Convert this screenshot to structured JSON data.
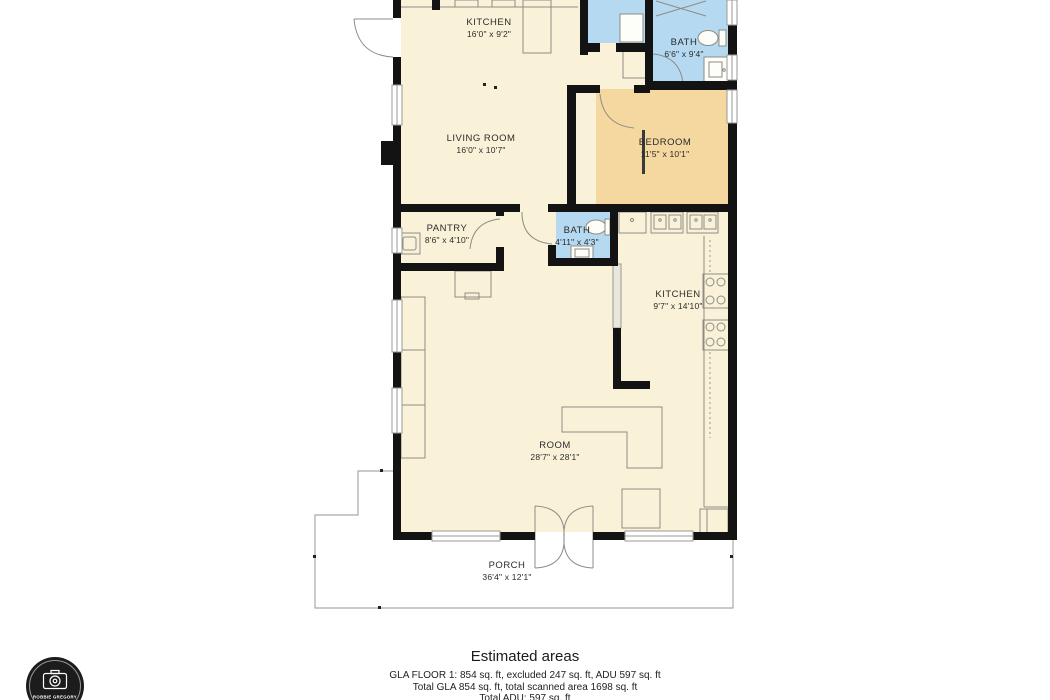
{
  "plan": {
    "rooms": [
      {
        "id": "kitchen-1",
        "name": "KITCHEN",
        "dims": "16'0\" x 9'2\""
      },
      {
        "id": "bath-1",
        "name": "BATH",
        "dims": "6'6\" x 9'4\""
      },
      {
        "id": "living-room",
        "name": "LIVING ROOM",
        "dims": "16'0\" x 10'7\""
      },
      {
        "id": "bedroom",
        "name": "BEDROOM",
        "dims": "11'5\" x 10'1\""
      },
      {
        "id": "pantry",
        "name": "PANTRY",
        "dims": "8'6\" x 4'10\""
      },
      {
        "id": "bath-2",
        "name": "BATH",
        "dims": "4'11\" x 4'3\""
      },
      {
        "id": "kitchen-2",
        "name": "KITCHEN",
        "dims": "9'7\" x 14'10\""
      },
      {
        "id": "room",
        "name": "ROOM",
        "dims": "28'7\" x 28'1\""
      },
      {
        "id": "porch",
        "name": "PORCH",
        "dims": "36'4\" x 12'1\""
      }
    ],
    "colors": {
      "floor_cream": "#f9f2d8",
      "bedroom_tan": "#f4d8a0",
      "bath_blue": "#b5d9f1",
      "wall": "#131313"
    }
  },
  "footer": {
    "title": "Estimated areas",
    "line1": "GLA FLOOR 1: 854 sq. ft, excluded 247 sq. ft, ADU 597 sq. ft",
    "line2": "Total GLA 854 sq. ft, total scanned area 1698 sq. ft",
    "line3": "Total ADU: 597 sq. ft"
  },
  "logo": {
    "brand": "ROBBIE GREGORY"
  }
}
